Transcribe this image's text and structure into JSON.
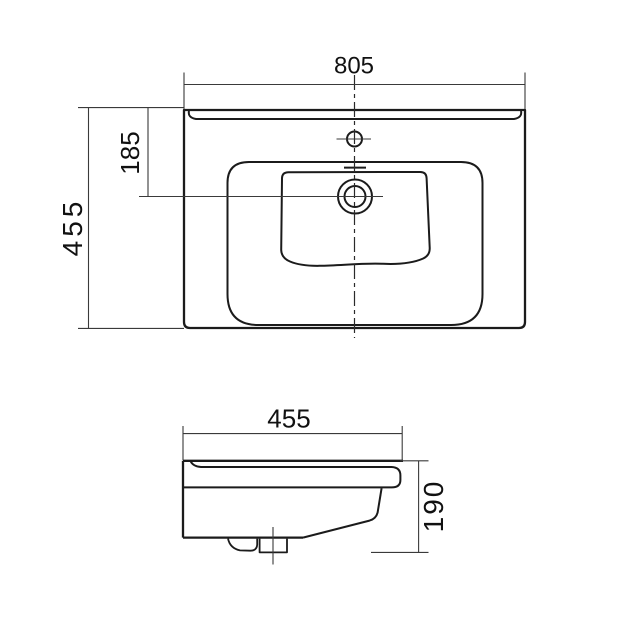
{
  "drawing": {
    "background_color": "#ffffff",
    "line_color": "#1b1b1b",
    "dimension_line_color": "#3a3a3a",
    "top_view": {
      "width": "805",
      "depth": "455",
      "bowl_center_offset": "185"
    },
    "side_view": {
      "depth": "455",
      "height": "190"
    }
  }
}
